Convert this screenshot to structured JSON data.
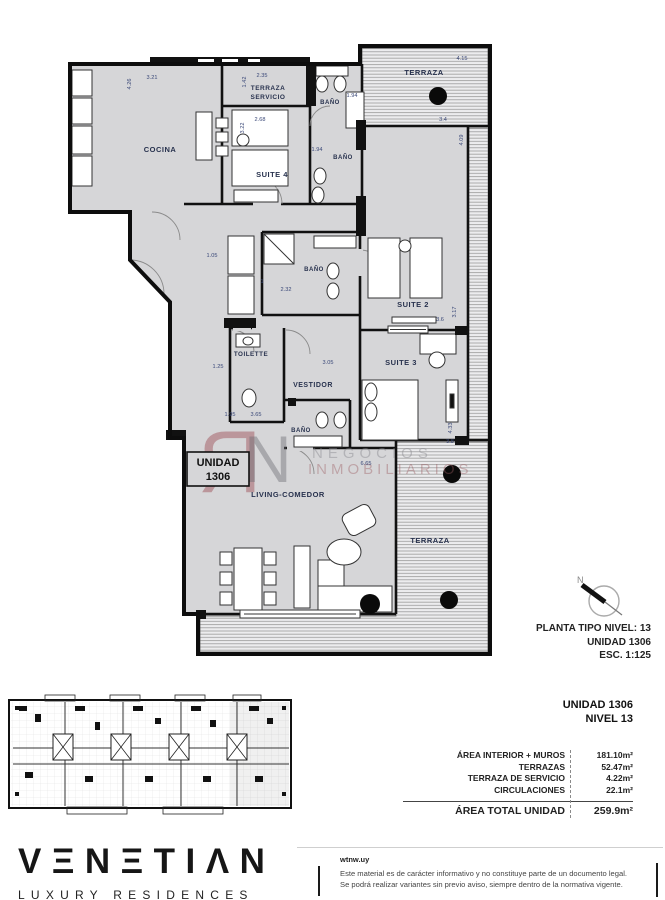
{
  "floorplan": {
    "rooms": {
      "cocina": "COCINA",
      "terraza_servicio_line1": "TERRAZA",
      "terraza_servicio_line2": "SERVICIO",
      "bano_top": "BAÑO",
      "suite4": "SUITE 4",
      "bano_mid": "BAÑO",
      "terraza_top": "TERRAZA",
      "bano_hall": "BAÑO",
      "suite2": "SUITE 2",
      "toilette": "TOILETTE",
      "vestidor": "VESTIDOR",
      "suite3": "SUITE 3",
      "bano_living": "BAÑO",
      "living": "LIVING-COMEDOR",
      "terraza_right": "TERRAZA"
    },
    "unit_box": {
      "line1": "UNIDAD",
      "line2": "1306"
    },
    "dims": [
      "4.26",
      "3.21",
      "1.42",
      "2.35",
      "2.68",
      "3.22",
      "1.94",
      "1.94",
      "4.15",
      "3.4",
      "4.09",
      "1.05",
      "2.32",
      "1",
      "3.6",
      "3.17",
      "1.25",
      "3.05",
      "4.33",
      "3.8",
      "1.95",
      "3.65",
      "6.65"
    ],
    "compass_n": "N",
    "watermark": {
      "monogram_r": "Я",
      "monogram_n": "N",
      "line1": "NEGOCIOS",
      "line2": "INMOBILIARIOS"
    },
    "caption": {
      "line1": "PLANTA TIPO NIVEL: 13",
      "line2": "UNIDAD 1306",
      "line3": "ESC.  1:125"
    }
  },
  "info": {
    "unit": "UNIDAD 1306",
    "level": "NIVEL 13",
    "rows": [
      {
        "label": "ÁREA INTERIOR + MUROS",
        "value": "181.10m²"
      },
      {
        "label": "TERRAZAS",
        "value": "52.47m²"
      },
      {
        "label": "TERRAZA DE SERVICIO",
        "value": "4.22m²"
      },
      {
        "label": "CIRCULACIONES",
        "value": "22.1m²"
      }
    ],
    "total_label": "ÁREA TOTAL UNIDAD",
    "total_value": "259.9m²"
  },
  "footer": {
    "logo": "VΞNΞTIΛN",
    "logo_sub": "LUXURY RESIDENCES",
    "site": "wtnw.uy",
    "disclaimer1": "Este material es de carácter informativo y no constituye parte de un documento legal.",
    "disclaimer2": "Se podrá realizar variantes sin previo aviso, siempre dentro de la normativa vigente."
  },
  "colors": {
    "plan_fill": "#d6d6d8",
    "wall": "#111111",
    "hatch_line": "#9b9b9b",
    "label_navy": "#28324e",
    "dim_blue": "#3a4878",
    "watermark_maroon": "#9b4a52"
  }
}
